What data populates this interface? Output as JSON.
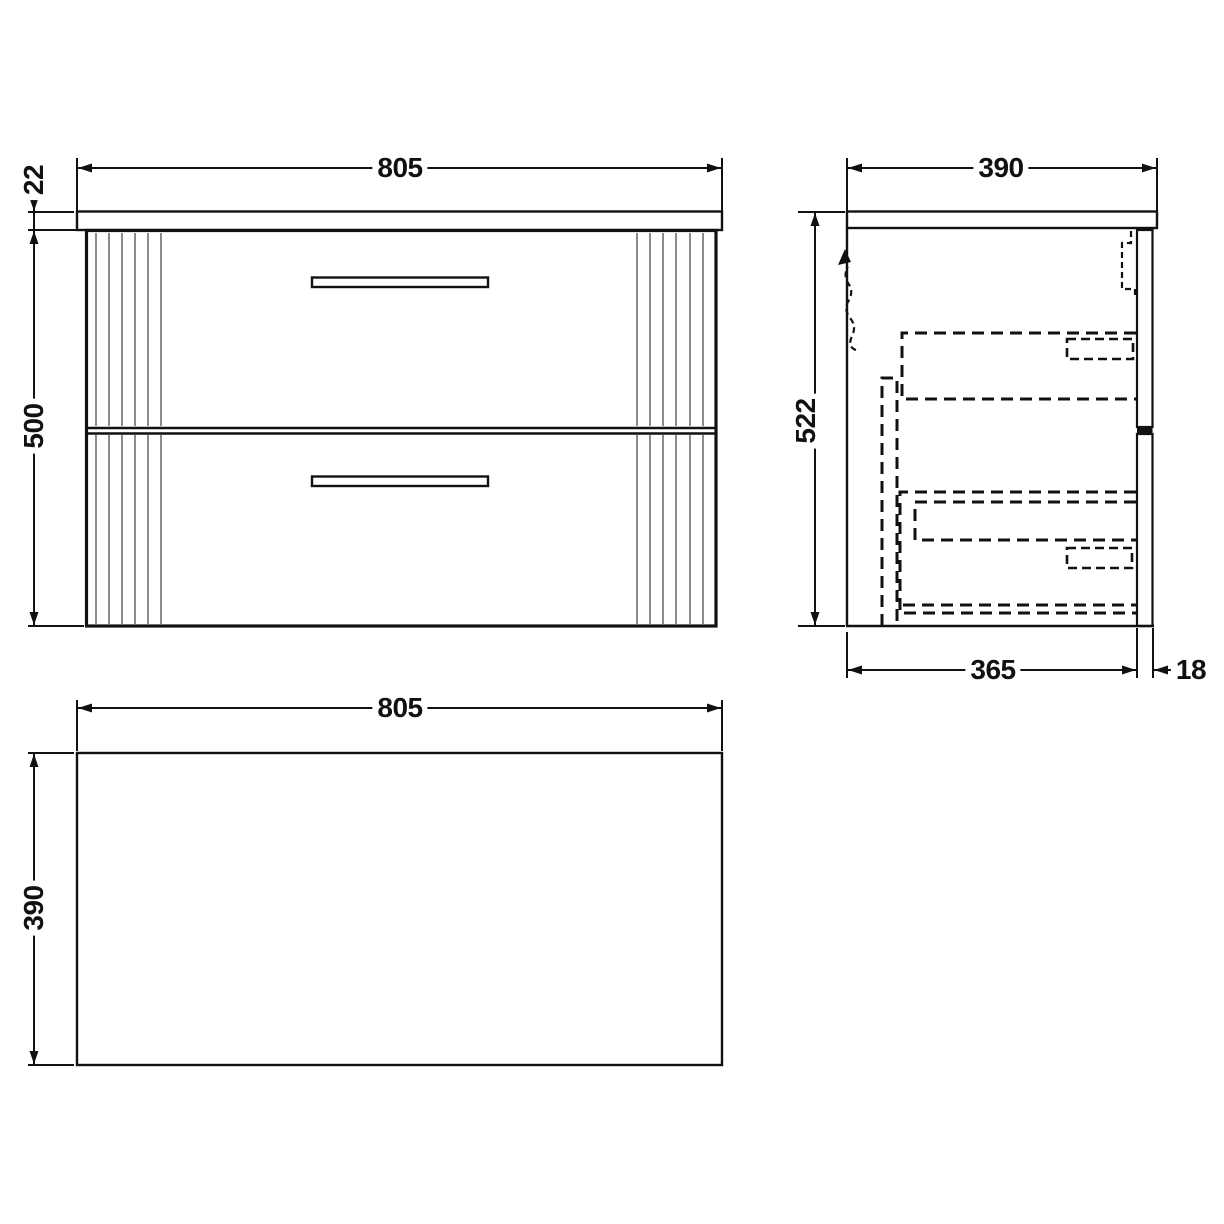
{
  "views": {
    "front": {
      "width": "805",
      "worktop_thickness": "22",
      "height": "500"
    },
    "side": {
      "depth": "390",
      "height": "522",
      "body_depth": "365",
      "front_panel_thickness": "18"
    },
    "plan": {
      "width": "805",
      "depth": "390"
    }
  }
}
